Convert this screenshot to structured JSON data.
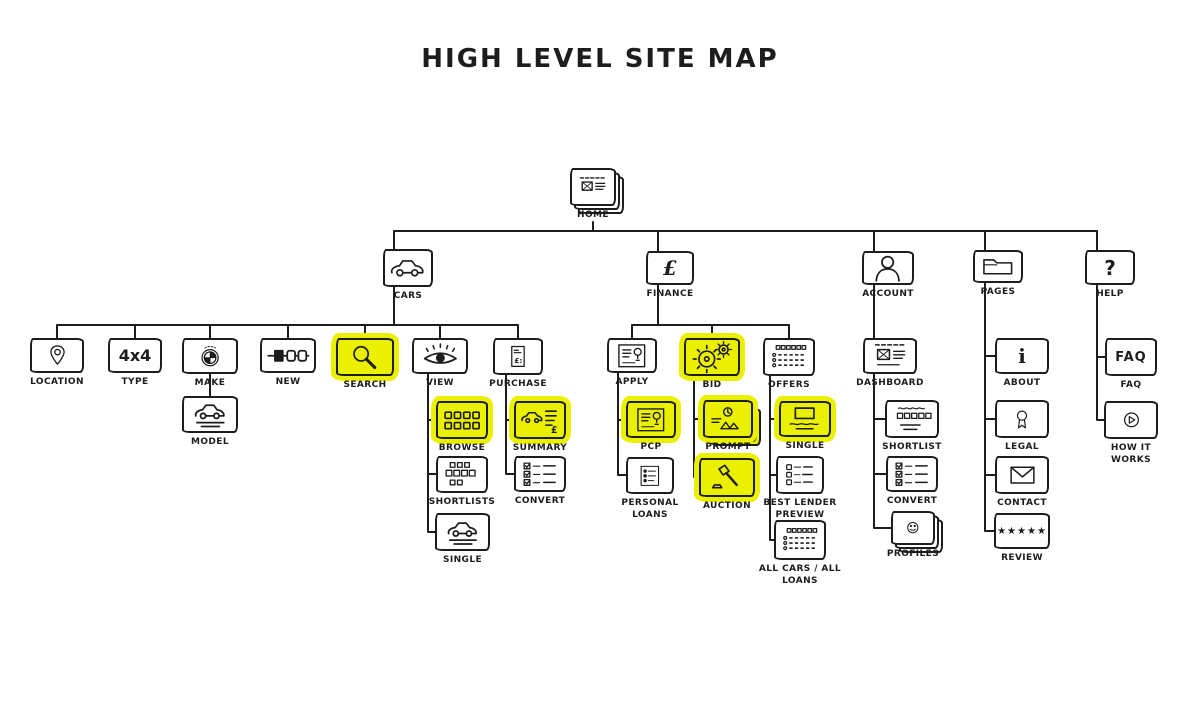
{
  "title": "HIGH LEVEL SITE MAP",
  "colors": {
    "highlight": "#ebf000",
    "ink": "#1d1d1d"
  },
  "nodes": {
    "home": {
      "label": "HOME"
    },
    "cars": {
      "label": "CARS"
    },
    "finance": {
      "label": "FINANCE",
      "glyph": "£"
    },
    "account": {
      "label": "ACCOUNT"
    },
    "pages": {
      "label": "PAGES"
    },
    "help": {
      "label": "HELP",
      "glyph": "?"
    },
    "location": {
      "label": "LOCATION"
    },
    "type": {
      "label": "TYPE",
      "glyph": "4x4"
    },
    "make": {
      "label": "MAKE"
    },
    "new": {
      "label": "NEW"
    },
    "search": {
      "label": "SEARCH"
    },
    "view": {
      "label": "VIEW"
    },
    "purchase": {
      "label": "PURCHASE"
    },
    "model": {
      "label": "MODEL"
    },
    "browse": {
      "label": "BROWSE"
    },
    "shortlists": {
      "label": "SHORTLISTS"
    },
    "single_cars": {
      "label": "SINGLE"
    },
    "summary": {
      "label": "SUMMARY"
    },
    "convert_cars": {
      "label": "CONVERT"
    },
    "apply": {
      "label": "APPLY"
    },
    "bid": {
      "label": "BID"
    },
    "offers": {
      "label": "OFFERS"
    },
    "pcp": {
      "label": "PCP"
    },
    "personal_loans": {
      "label": "PERSONAL\nLOANS"
    },
    "prompt": {
      "label": "PROMPT"
    },
    "auction": {
      "label": "AUCTION"
    },
    "single_finance": {
      "label": "SINGLE"
    },
    "best_lender_preview": {
      "label": "BEST LENDER\nPREVIEW"
    },
    "all_cars_all_loans": {
      "label": "ALL CARS / ALL\nLOANS"
    },
    "dashboard": {
      "label": "DASHBOARD"
    },
    "shortlist_account": {
      "label": "SHORTLIST"
    },
    "convert_account": {
      "label": "CONVERT"
    },
    "profiles": {
      "label": "PROFILES"
    },
    "about": {
      "label": "ABOUT",
      "glyph": "i"
    },
    "legal": {
      "label": "LEGAL"
    },
    "contact": {
      "label": "CONTACT"
    },
    "review": {
      "label": "REVIEW",
      "glyph": "★★★★★"
    },
    "faq": {
      "label": "FAQ",
      "glyph": "FAQ"
    },
    "how_it_works": {
      "label": "HOW IT\nWORKS"
    }
  }
}
